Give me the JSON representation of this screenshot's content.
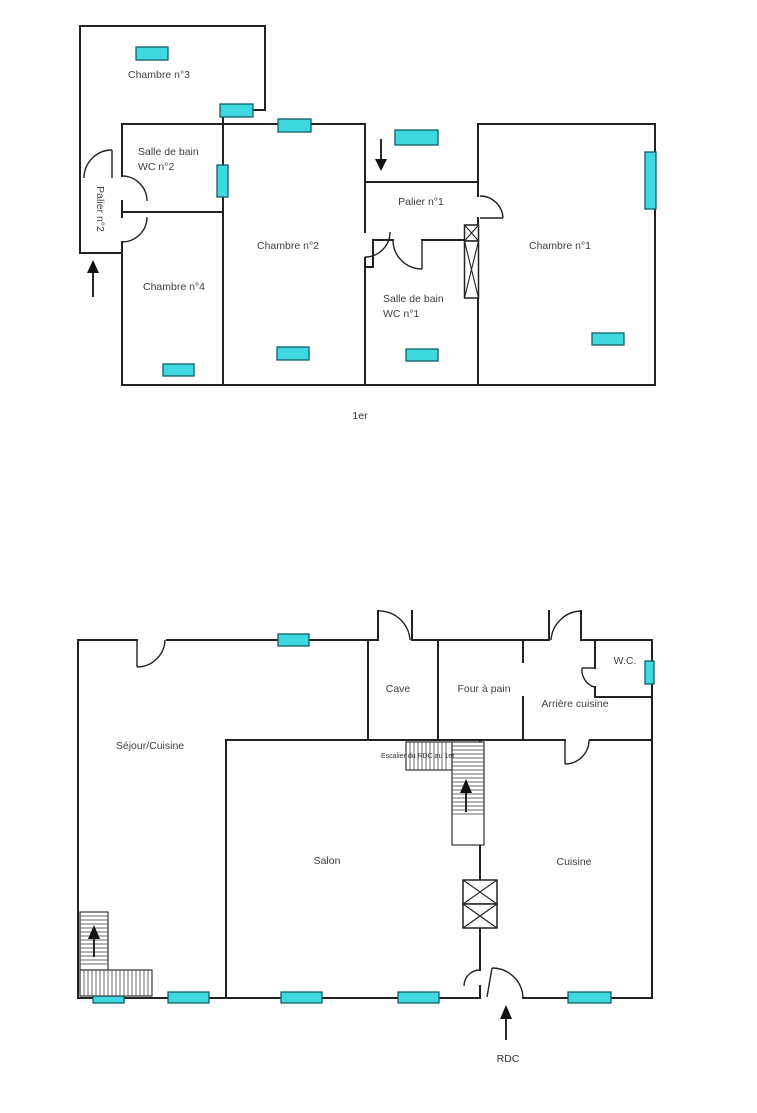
{
  "document": {
    "type": "floorplan",
    "floors": 2
  },
  "colors": {
    "wall_color": "#222222",
    "window_fill": "#3fd7e0",
    "window_stroke": "#0e5f66",
    "label_color": "#3f3f3f"
  },
  "floor1": {
    "label": "1er",
    "rooms": {
      "chambre3": "Chambre n°3",
      "sdb2": "Salle de bain\nWC n°2",
      "palier2": "Palier n°2",
      "chambre2": "Chambre n°2",
      "palier1": "Palier n°1",
      "chambre1": "Chambre n°1",
      "chambre4": "Chambre n°4",
      "sdb1": "Salle de bain\nWC n°1"
    }
  },
  "rdc": {
    "label": "RDC",
    "rooms": {
      "sejour": "Séjour/Cuisine",
      "cave": "Cave",
      "four": "Four à pain",
      "wc": "W.C.",
      "arriere": "Arrière cuisine",
      "salon": "Salon",
      "cuisine": "Cuisine"
    },
    "stair_label": "Escalier du RDC au 1er"
  }
}
